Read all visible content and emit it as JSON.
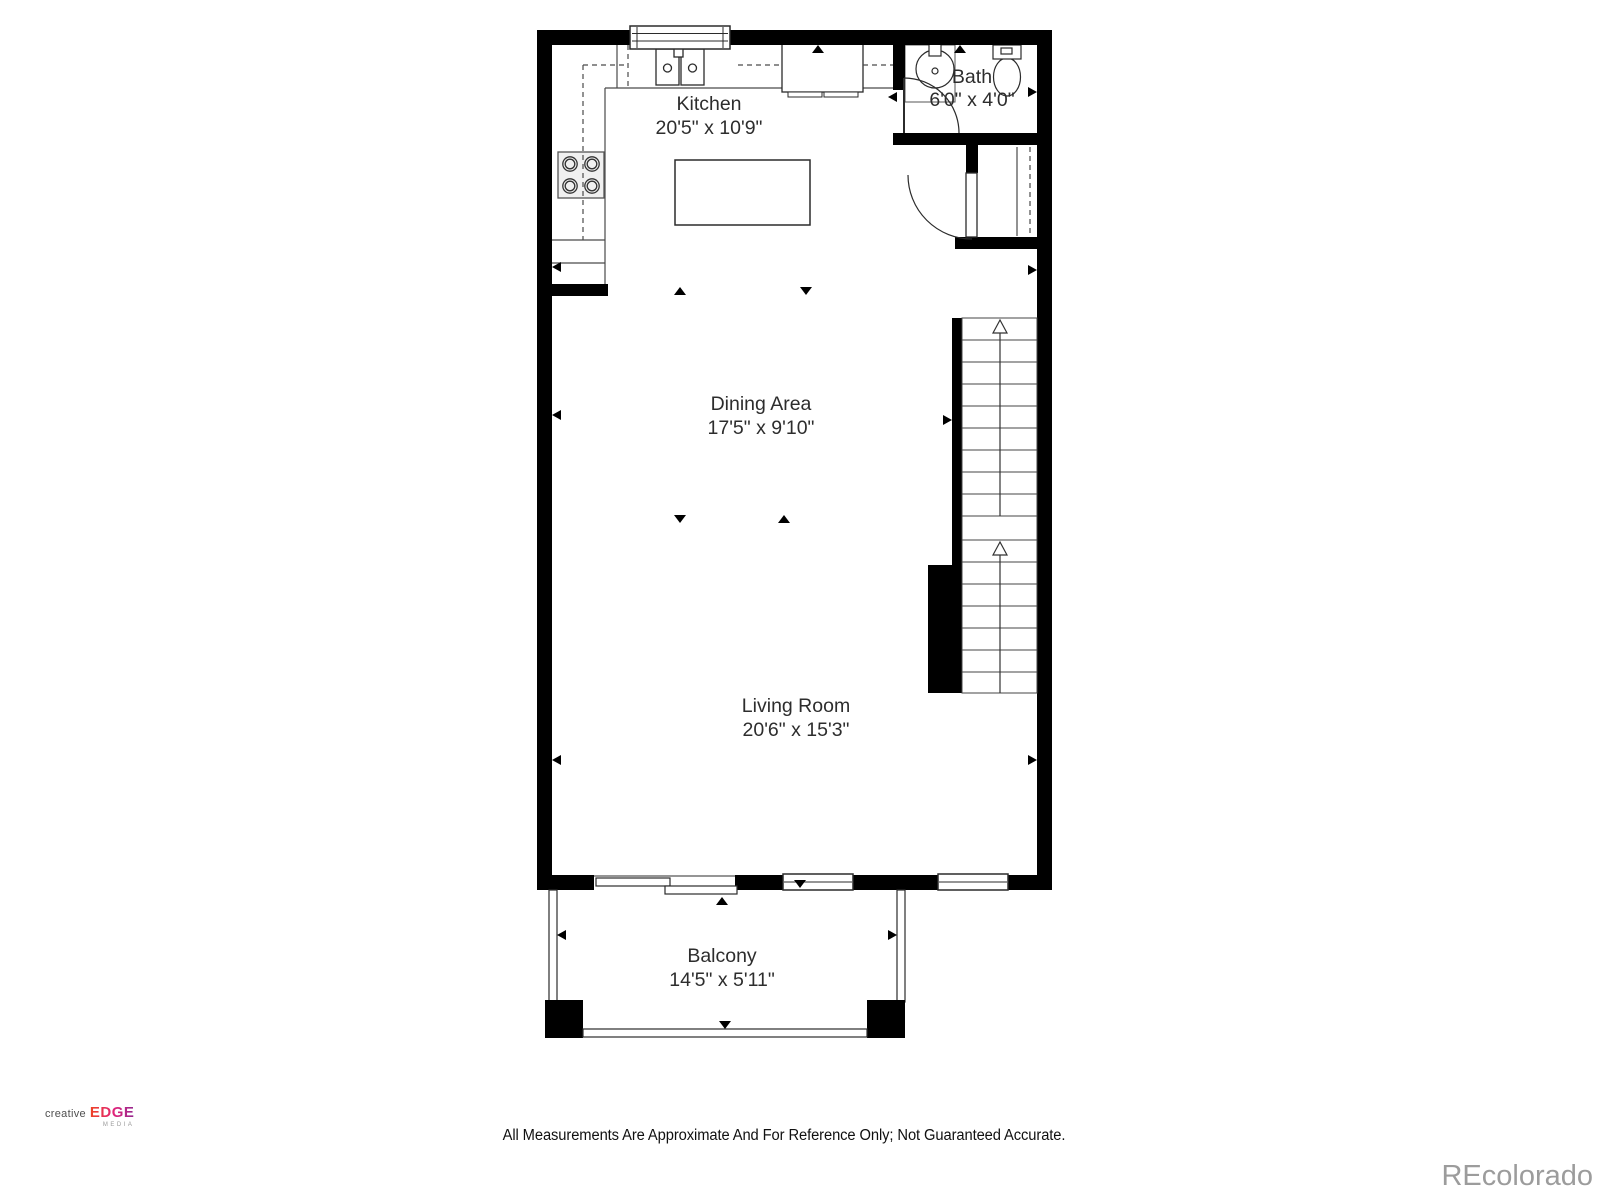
{
  "plan": {
    "rooms": [
      {
        "name": "Kitchen",
        "dimensions": "20'5\" x 10'9\""
      },
      {
        "name": "Bath",
        "dimensions": "6'0\" x 4'0\""
      },
      {
        "name": "Dining Area",
        "dimensions": "17'5\" x 9'10\""
      },
      {
        "name": "Living Room",
        "dimensions": "20'6\" x 15'3\""
      },
      {
        "name": "Balcony",
        "dimensions": "14'5\" x 5'11\""
      }
    ],
    "features": [
      "stove",
      "double-sink",
      "refrigerator",
      "kitchen-island",
      "bath-vanity-sink",
      "toilet",
      "closet",
      "stairs-up",
      "sliding-door",
      "windows",
      "balcony-railing"
    ]
  },
  "footer": {
    "disclaimer": "All Measurements Are Approximate And For Reference Only; Not Guaranteed Accurate."
  },
  "branding": {
    "logo_creative": "creative",
    "logo_edge": "EDGE",
    "logo_media": "MEDIA",
    "watermark": "REcolorado"
  },
  "colors": {
    "wall": "#000000",
    "fixture_line": "#2b2b2b",
    "counter_line": "#4a4a4a",
    "label_text": "#2d2d2d",
    "logo_accent_start": "#ee4323",
    "logo_accent_end": "#93278f",
    "watermark_gray": "#9c9c9c"
  }
}
